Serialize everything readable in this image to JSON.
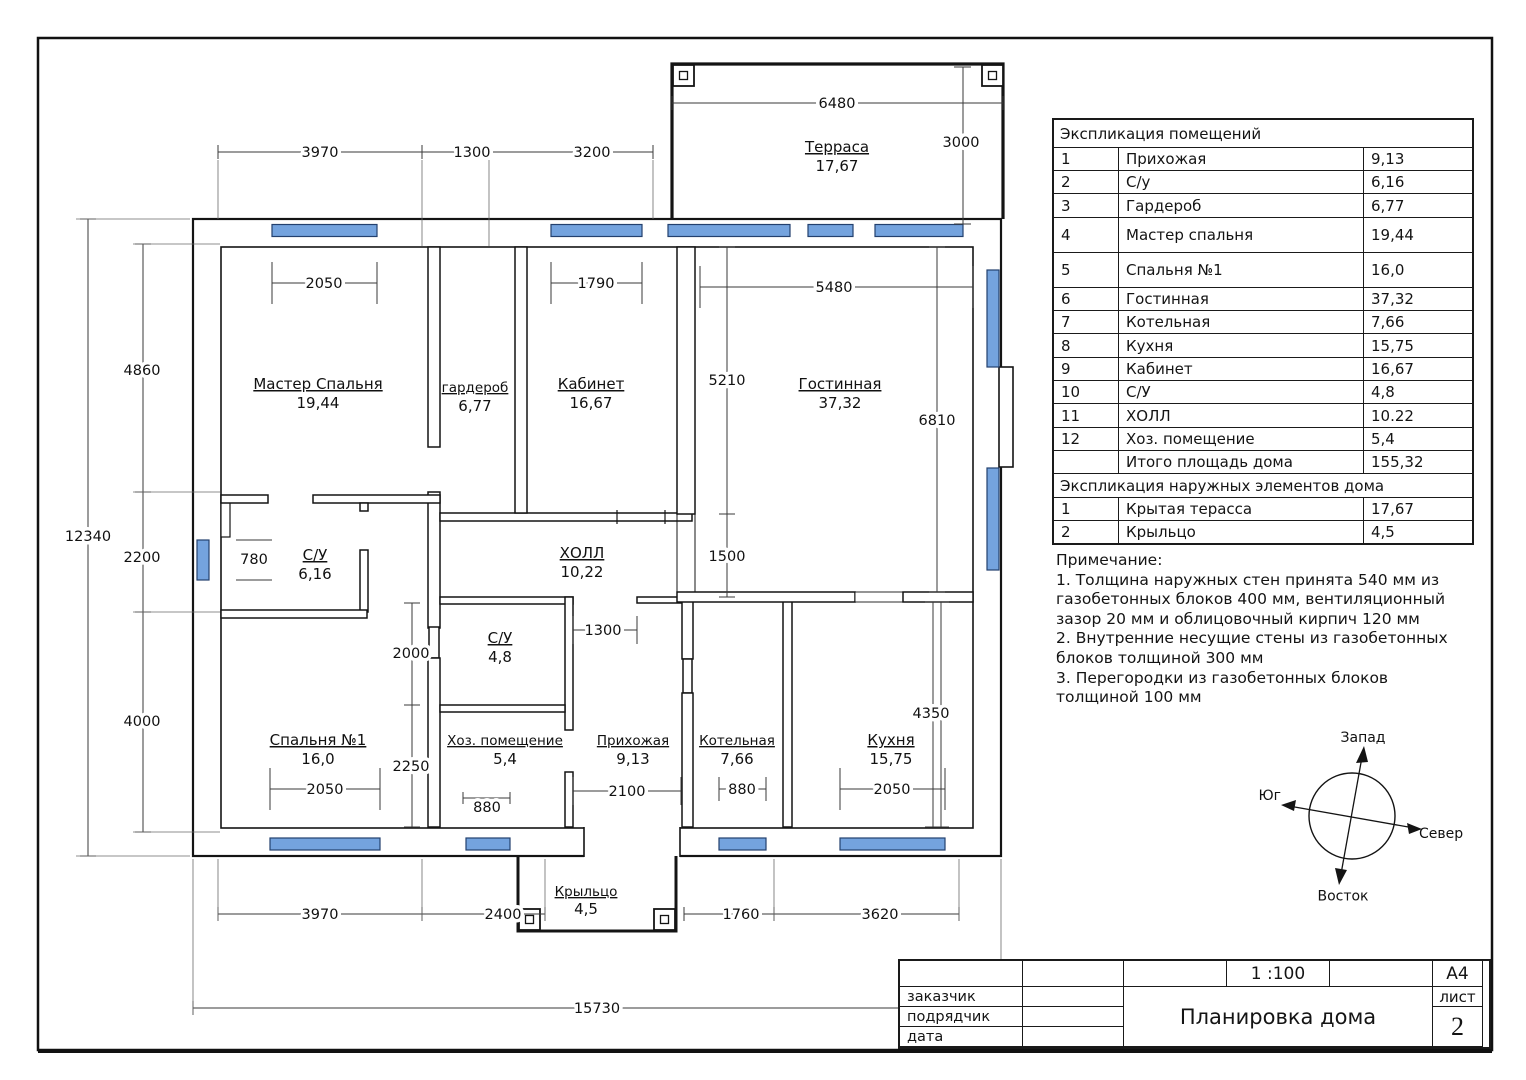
{
  "sheet": {
    "title": "Планировка дома",
    "scale": "1 :100",
    "format": "А4",
    "sheet_label": "лист",
    "sheet_number": "2",
    "fields": {
      "customer": "заказчик",
      "contractor": "подрядчик",
      "date": "дата"
    }
  },
  "colors": {
    "window_blue": "#74a3de",
    "line": "#141414"
  },
  "explication": {
    "title": "Экспликация помещений",
    "rows": [
      {
        "num": "1",
        "name": "Прихожая",
        "area": "9,13"
      },
      {
        "num": "2",
        "name": "С/у",
        "area": "6,16"
      },
      {
        "num": "3",
        "name": "Гардероб",
        "area": "6,77"
      },
      {
        "num": "4",
        "name": "Мастер спальня",
        "area": "19,44"
      },
      {
        "num": "5",
        "name": "Спальня №1",
        "area": "16,0"
      },
      {
        "num": "6",
        "name": "Гостинная",
        "area": "37,32"
      },
      {
        "num": "7",
        "name": "Котельная",
        "area": "7,66"
      },
      {
        "num": "8",
        "name": "Кухня",
        "area": "15,75"
      },
      {
        "num": "9",
        "name": "Кабинет",
        "area": "16,67"
      },
      {
        "num": "10",
        "name": "С/У",
        "area": "4,8"
      },
      {
        "num": "11",
        "name": "ХОЛЛ",
        "area": "10.22"
      },
      {
        "num": "12",
        "name": "Хоз. помещение",
        "area": "5,4"
      }
    ],
    "total_label": "Итого площадь дома",
    "total_area": "155,32",
    "external_title": "Экспликация наружных элементов дома",
    "external_rows": [
      {
        "num": "1",
        "name": "Крытая терасса",
        "area": "17,67"
      },
      {
        "num": "2",
        "name": "Крыльцо",
        "area": "4,5"
      }
    ]
  },
  "notes": {
    "title": "Примечание:",
    "lines": [
      "1. Толщина наружных стен принята 540 мм из",
      "газобетонных блоков 400 мм, вентиляционный",
      "зазор 20 мм и облицовочный кирпич 120 мм",
      "2. Внутренние несущие стены из газобетонных",
      "блоков толщиной 300 мм",
      "3. Перегородки из газобетонных блоков",
      "толщиной 100 мм"
    ]
  },
  "compass": {
    "west": "Запад",
    "south": "Юг",
    "north": "Север",
    "east": "Восток"
  },
  "plan": {
    "rooms": {
      "terrace": {
        "name": "Терраса",
        "area": "17,67"
      },
      "master": {
        "name": "Мастер Спальня",
        "area": "19,44"
      },
      "wardrobe": {
        "name": "гардероб",
        "area": "6,77"
      },
      "cabinet": {
        "name": "Кабинет",
        "area": "16,67"
      },
      "living": {
        "name": "Гостинная",
        "area": "37,32"
      },
      "su1": {
        "name": "С/У",
        "area": "6,16"
      },
      "hall": {
        "name": "ХОЛЛ",
        "area": "10,22"
      },
      "su2": {
        "name": "С/У",
        "area": "4,8"
      },
      "bedroom1": {
        "name": "Спальня №1",
        "area": "16,0"
      },
      "utility": {
        "name": "Хоз. помещение",
        "area": "5,4"
      },
      "entry": {
        "name": "Прихожая",
        "area": "9,13"
      },
      "boiler": {
        "name": "Котельная",
        "area": "7,66"
      },
      "kitchen": {
        "name": "Кухня",
        "area": "15,75"
      },
      "porch": {
        "name": "Крыльцо",
        "area": "4,5"
      }
    },
    "dims": {
      "top_3970": "3970",
      "top_1300": "1300",
      "top_3200": "3200",
      "terrace_6480": "6480",
      "terrace_3000": "3000",
      "left_12340": "12340",
      "left_4860": "4860",
      "left_2200": "2200",
      "left_4000": "4000",
      "master_2050": "2050",
      "cabinet_1790": "1790",
      "living_5480": "5480",
      "living_5210": "5210",
      "living_6810": "6810",
      "living_1500": "1500",
      "su1_780": "780",
      "mid_2000": "2000",
      "mid_2250": "2250",
      "su2_1300": "1300",
      "entry_2100": "2100",
      "utility_880": "880",
      "boiler_880": "880",
      "bedroom_2050": "2050",
      "kitchen_2050": "2050",
      "kitchen_4350": "4350",
      "bottom_3970": "3970",
      "bottom_2400": "2400",
      "bottom_1760": "1760",
      "bottom_3620": "3620",
      "total_15730": "15730"
    }
  }
}
